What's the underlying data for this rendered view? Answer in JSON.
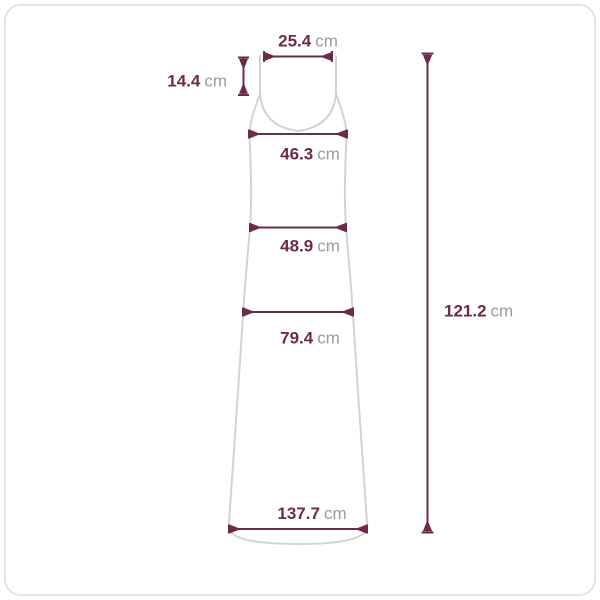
{
  "page": {
    "background": "#ffffff",
    "border_color": "#e3e3e3"
  },
  "diagram": {
    "type": "garment-size-measurement-diagram",
    "garment": "sleeveless-maxi-dress",
    "colors": {
      "measurement_line": "#6d2b4c",
      "value_text": "#6d2b4c",
      "unit_text": "#9a9a9a",
      "garment_outline": "#d3d3d3"
    },
    "measurements": {
      "shoulder_width": {
        "value": "25.4",
        "unit": "cm"
      },
      "strap_length": {
        "value": "14.4",
        "unit": "cm"
      },
      "bust_width": {
        "value": "46.3",
        "unit": "cm"
      },
      "waist_width": {
        "value": "48.9",
        "unit": "cm"
      },
      "hip_width": {
        "value": "79.4",
        "unit": "cm"
      },
      "hem_width": {
        "value": "137.7",
        "unit": "cm"
      },
      "total_length": {
        "value": "121.2",
        "unit": "cm"
      }
    }
  }
}
